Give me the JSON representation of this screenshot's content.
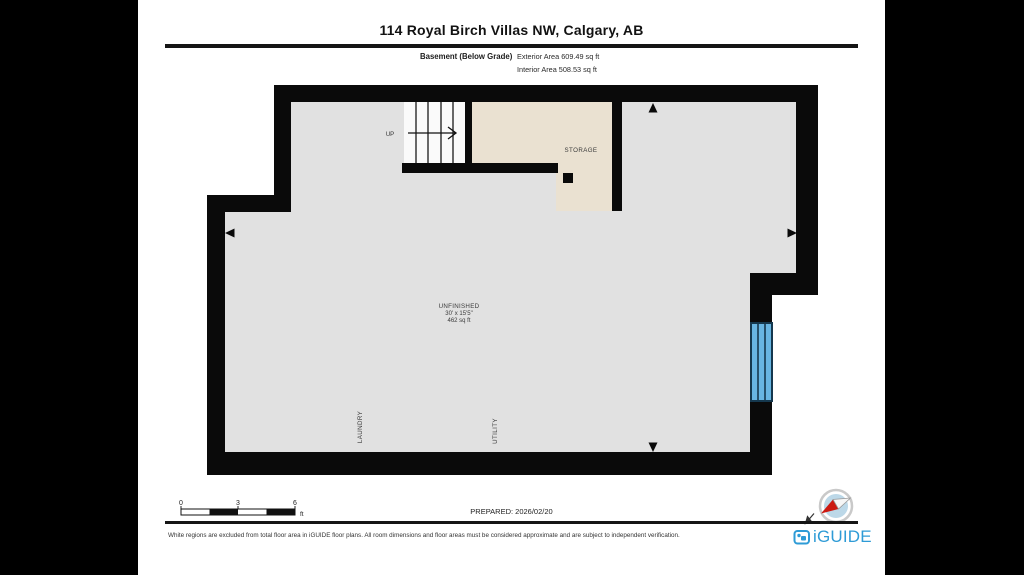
{
  "page": {
    "background": "#000000",
    "paper_color": "#ffffff"
  },
  "header": {
    "title": "114 Royal Birch Villas NW, Calgary, AB",
    "floor_label": "Basement (Below Grade)",
    "exterior_area": "Exterior Area 609.49 sq ft",
    "interior_area": "Interior Area 508.53 sq ft"
  },
  "floor_plan": {
    "stairs": {
      "label": "UP"
    },
    "rooms": {
      "storage": {
        "label": "STORAGE"
      },
      "unfinished": {
        "label": "UNFINISHED",
        "dimensions": "30' x 15'5\"",
        "area": "462 sq ft"
      },
      "laundry": {
        "label": "LAUNDRY"
      },
      "utility": {
        "label": "UTILITY"
      }
    },
    "colors": {
      "wall": "#0a0a0a",
      "floor": "#e1e1e1",
      "storage_floor": "#eae1d1",
      "stairs_floor": "#fafafa",
      "window_glass": "#68b5e2",
      "window_frame": "#15384e"
    }
  },
  "scale_bar": {
    "ticks": [
      "0",
      "3",
      "6"
    ],
    "unit": "ft"
  },
  "footer": {
    "prepared": "PREPARED: 2026/02/20",
    "disclaimer": "White regions are excluded from total floor area in iGUIDE floor plans. All room dimensions and floor areas must be considered approximate and are subject to independent verification.",
    "logo_text": "iGUIDE",
    "logo_color": "#2e9bd6"
  }
}
